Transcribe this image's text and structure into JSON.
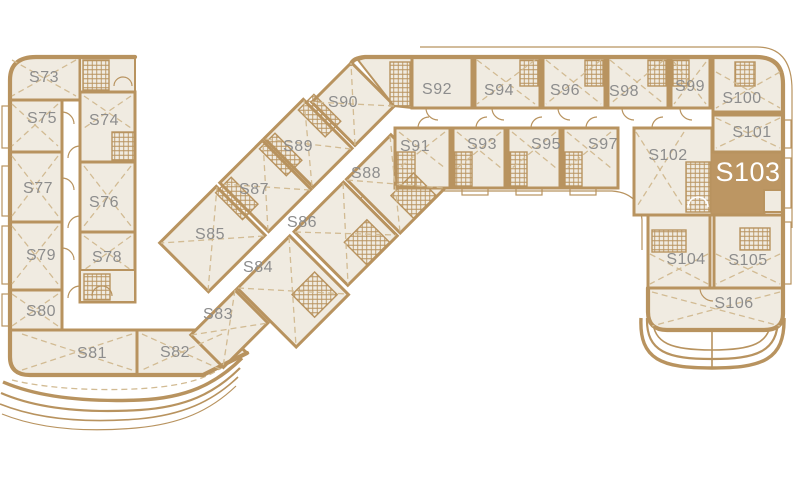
{
  "plan": {
    "selected_unit": "S103",
    "colors": {
      "wall": "#b8935f",
      "floor": "#f0ebe1",
      "highlight": "#bc9663",
      "corridor": "#ffffff",
      "label": "#8d8d8d",
      "selected_label": "#ffffff",
      "dashed_detail": "#d2bb93",
      "background": "#ffffff"
    }
  },
  "units": {
    "s73": {
      "label": "S73"
    },
    "s74": {
      "label": "S74"
    },
    "s75": {
      "label": "S75"
    },
    "s76": {
      "label": "S76"
    },
    "s77": {
      "label": "S77"
    },
    "s78": {
      "label": "S78"
    },
    "s79": {
      "label": "S79"
    },
    "s80": {
      "label": "S80"
    },
    "s81": {
      "label": "S81"
    },
    "s82": {
      "label": "S82"
    },
    "s83": {
      "label": "S83"
    },
    "s84": {
      "label": "S84"
    },
    "s85": {
      "label": "S85"
    },
    "s86": {
      "label": "S86"
    },
    "s87": {
      "label": "S87"
    },
    "s88": {
      "label": "S88"
    },
    "s89": {
      "label": "S89"
    },
    "s90": {
      "label": "S90"
    },
    "s91": {
      "label": "S91"
    },
    "s92": {
      "label": "S92"
    },
    "s93": {
      "label": "S93"
    },
    "s94": {
      "label": "S94"
    },
    "s95": {
      "label": "S95"
    },
    "s96": {
      "label": "S96"
    },
    "s97": {
      "label": "S97"
    },
    "s98": {
      "label": "S98"
    },
    "s99": {
      "label": "S99"
    },
    "s100": {
      "label": "S100"
    },
    "s101": {
      "label": "S101"
    },
    "s102": {
      "label": "S102"
    },
    "s103": {
      "label": "S103"
    },
    "s104": {
      "label": "S104"
    },
    "s105": {
      "label": "S105"
    },
    "s106": {
      "label": "S106"
    }
  }
}
